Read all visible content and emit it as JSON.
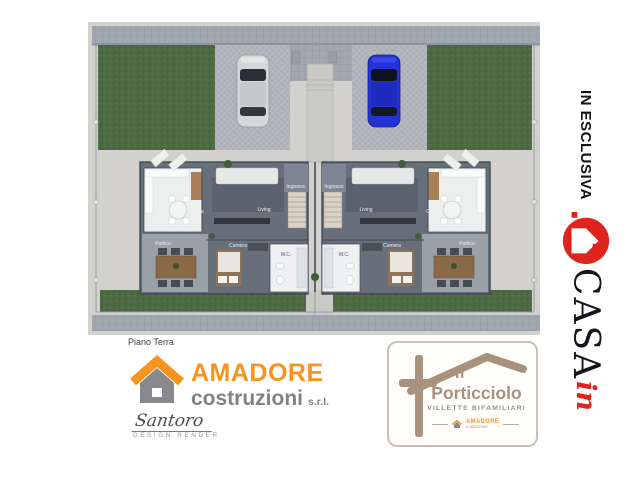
{
  "plan": {
    "caption": "Piano Terra",
    "unit_count": 2,
    "rooms": {
      "ingresso": "Ingresso",
      "living": "Living",
      "cucina": "Cucina",
      "camera": "Camera",
      "wc": "W.C.",
      "portico": "Portico"
    },
    "icons": {
      "car_left": "silver-car",
      "car_right": "blue-car",
      "loungers": "sun-loungers",
      "dining": "portico-dining-table",
      "stairs": "staircase"
    },
    "colors": {
      "grass": "#4e6a44",
      "concrete": "#d2d1cd",
      "paving": "#b5b9bf",
      "walls": "#666f7a",
      "car_left": "#d6d7d9",
      "car_right": "#2433d6"
    }
  },
  "builder": {
    "name": "AMADORE",
    "line2": "costruzioni",
    "suffix": "s.r.l.",
    "accent": "#F7941E",
    "gray": "#808285"
  },
  "designer": {
    "signature": "Santoro",
    "label": "DESIGN RENDER"
  },
  "project": {
    "prefix": "Il",
    "name": "Porticciolo",
    "subtitle": "VILLETTE BIFAMILIARI",
    "color": "#A6917E"
  },
  "ribbon": {
    "text": "IN ESCLUSIVA",
    "brand": "CASA",
    "brand_script": "in",
    "red": "#E0231C"
  }
}
